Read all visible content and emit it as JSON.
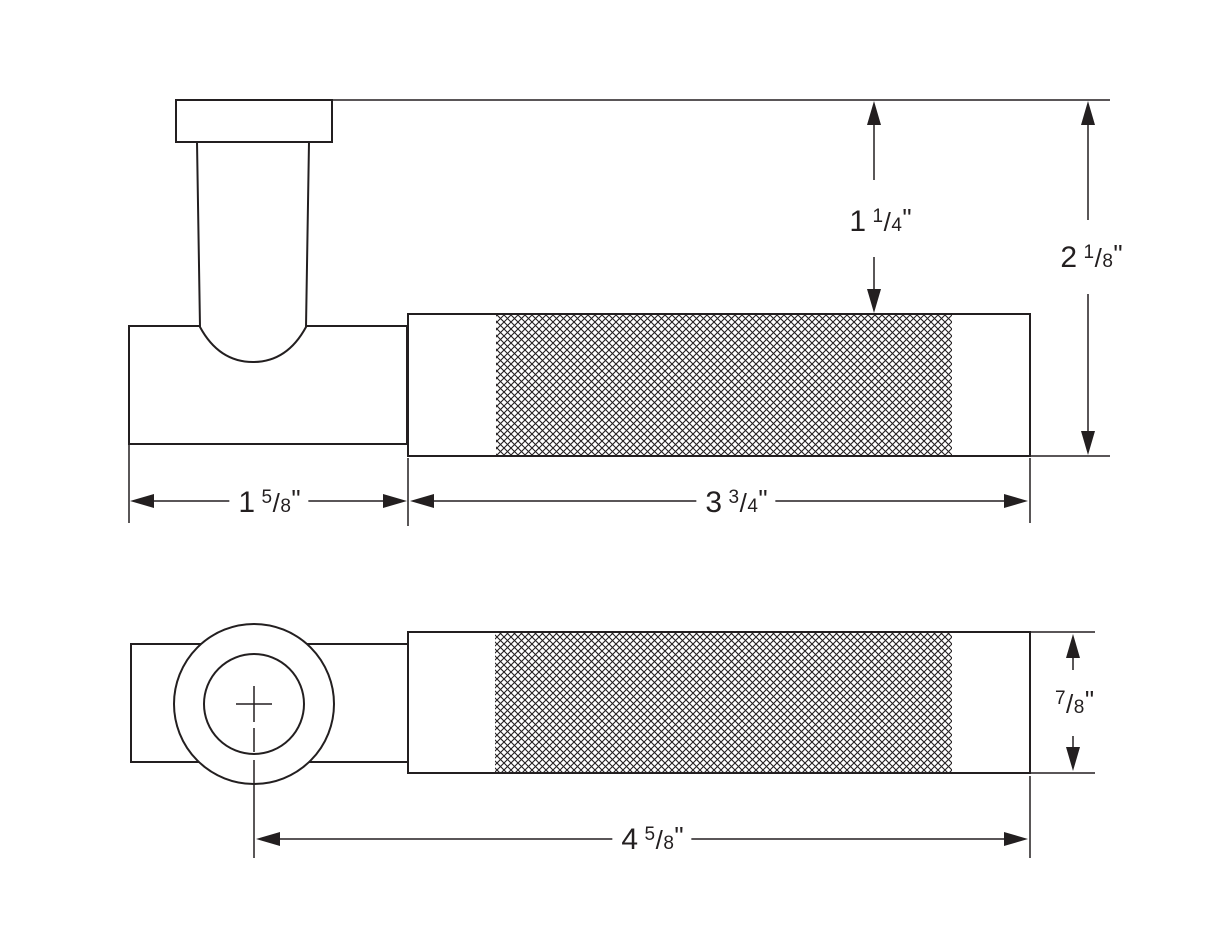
{
  "colors": {
    "line": "#231f20",
    "background": "#ffffff"
  },
  "glyphs": {
    "fraction_slash": "/"
  },
  "dimensions": {
    "post_to_grip_height": {
      "whole": "1",
      "numerator": "1",
      "denominator": "4",
      "unit": "\""
    },
    "overall_height": {
      "whole": "2",
      "numerator": "1",
      "denominator": "8",
      "unit": "\""
    },
    "hub_length": {
      "whole": "1",
      "numerator": "5",
      "denominator": "8",
      "unit": "\""
    },
    "grip_length": {
      "whole": "3",
      "numerator": "3",
      "denominator": "4",
      "unit": "\""
    },
    "grip_diameter": {
      "whole": "",
      "numerator": "7",
      "denominator": "8",
      "unit": "\""
    },
    "overall_length": {
      "whole": "4",
      "numerator": "5",
      "denominator": "8",
      "unit": "\""
    }
  }
}
